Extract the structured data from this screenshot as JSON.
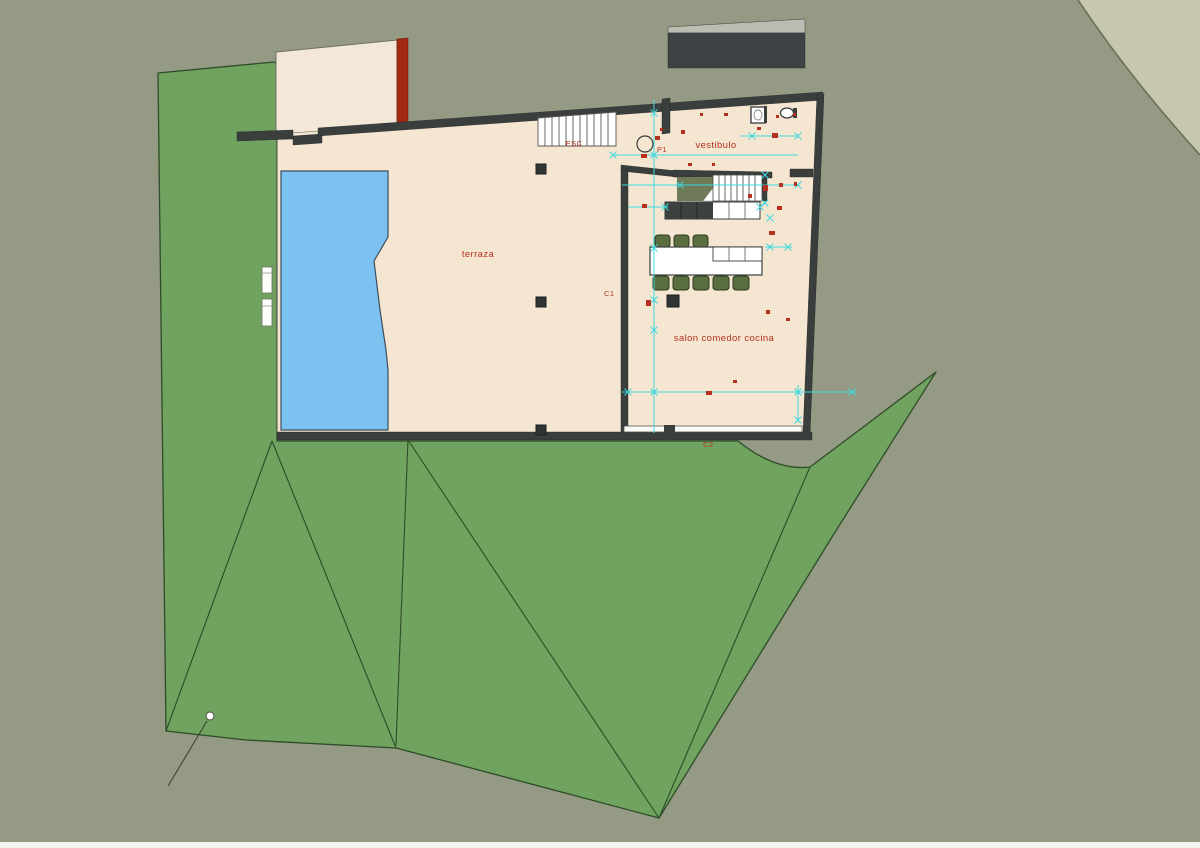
{
  "drawing": {
    "title": "site floor plan",
    "labels": {
      "terrace": "terraza",
      "vestibule": "vestibulo",
      "living": "salon comedor cocina",
      "stairs_exterior": "ESC",
      "p1": "P1",
      "c1": "C1",
      "c2": "C2"
    },
    "colors": {
      "background": "#949a83",
      "corner_light": "#c7c7ae",
      "terrain_green": "#6fa35f",
      "terrain_edge": "#2e4c28",
      "floor": "#f4e6d1",
      "upper_block": "#f3e8d8",
      "wall": "#3a3e3d",
      "red_wall": "#a32a12",
      "pool": "#7cc2f0",
      "roof_dark": "#3e4245",
      "roof_light": "#b9bdb2",
      "stair_void": "#6e7a58",
      "counter_dark": "#3c4140",
      "chair": "#5a6f3f",
      "cad_red": "#b5301f",
      "cad_cyan": "#3fd9de",
      "white": "#ffffff",
      "bottom_strip": "#f2f2ef"
    },
    "annotations": {
      "dim_lines": [
        [
          654,
          100,
          654,
          433
        ],
        [
          613,
          155,
          798,
          155
        ],
        [
          622,
          185,
          798,
          185
        ],
        [
          628,
          207,
          668,
          207
        ],
        [
          740,
          136,
          799,
          136
        ],
        [
          765,
          247,
          792,
          247
        ],
        [
          622,
          392,
          855,
          392
        ],
        [
          798,
          385,
          798,
          422
        ]
      ],
      "dim_ticks": [
        [
          654,
          113
        ],
        [
          654,
          155
        ],
        [
          613,
          155
        ],
        [
          752,
          136
        ],
        [
          798,
          136
        ],
        [
          680,
          185
        ],
        [
          798,
          185
        ],
        [
          665,
          207
        ],
        [
          760,
          207
        ],
        [
          770,
          218
        ],
        [
          765,
          175
        ],
        [
          765,
          203
        ],
        [
          770,
          247
        ],
        [
          788,
          247
        ],
        [
          628,
          392
        ],
        [
          798,
          392
        ],
        [
          852,
          392
        ],
        [
          798,
          420
        ],
        [
          654,
          248
        ],
        [
          654,
          330
        ],
        [
          654,
          392
        ],
        [
          654,
          300
        ]
      ],
      "red_marks": [
        [
          655,
          136,
          5,
          4
        ],
        [
          641,
          154,
          6,
          4
        ],
        [
          681,
          130,
          4,
          4
        ],
        [
          757,
          127,
          4,
          3
        ],
        [
          772,
          133,
          6,
          5
        ],
        [
          776,
          115,
          3,
          3
        ],
        [
          793,
          113,
          3,
          3
        ],
        [
          779,
          183,
          4,
          4
        ],
        [
          794,
          182,
          3,
          4
        ],
        [
          777,
          206,
          5,
          4
        ],
        [
          769,
          231,
          6,
          4
        ],
        [
          763,
          185,
          5,
          6
        ],
        [
          642,
          204,
          5,
          4
        ],
        [
          646,
          300,
          5,
          6
        ],
        [
          706,
          391,
          6,
          4
        ],
        [
          733,
          380,
          4,
          3
        ],
        [
          766,
          310,
          4,
          4
        ],
        [
          688,
          163,
          4,
          3
        ],
        [
          712,
          163,
          3,
          3
        ],
        [
          748,
          194,
          4,
          4
        ],
        [
          786,
          318,
          4,
          3
        ],
        [
          660,
          128,
          3,
          3
        ],
        [
          700,
          113,
          3,
          3
        ],
        [
          724,
          113,
          4,
          3
        ]
      ]
    }
  }
}
